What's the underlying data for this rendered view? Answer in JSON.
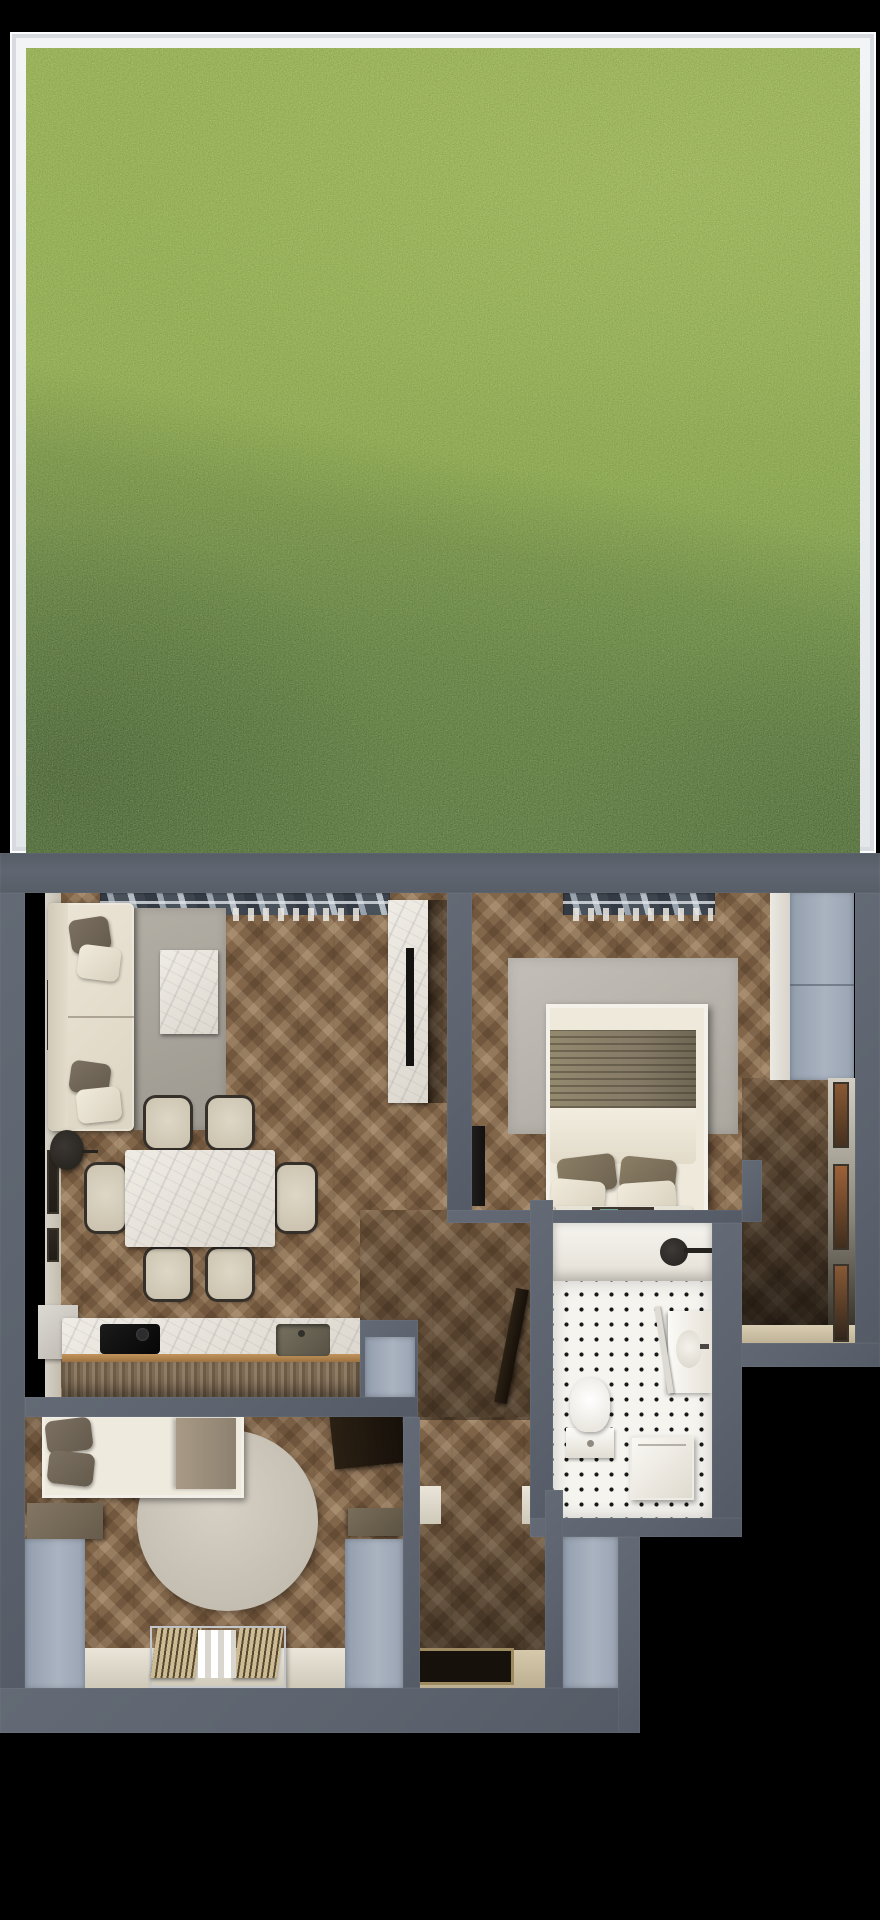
{
  "meta": {
    "title": "Top-down 3D render: apartment floor plan with private terrace lawn",
    "view": "top-down cutaway",
    "background": "#000000"
  },
  "palette": {
    "lawn_light": "#a9bf55",
    "lawn_shadow": "#688c46",
    "frame_white": "#eef0f3",
    "wall_gray": "#5c636e",
    "wardrobe_panel": "#a0aab8",
    "parquet_brown": "#82664a",
    "bathroom_tile": "#f6f4ef",
    "tile_dot": "#181818",
    "upholstery_cream": "#ece5d6",
    "pillow_taupe": "#6e6354",
    "marble_white": "#eae6de"
  },
  "terrace": {
    "name": "Terrace lawn",
    "features": [
      "white frame border",
      "sunlit upper lawn",
      "diagonal shadow across lower lawn"
    ]
  },
  "rooms": {
    "living": {
      "name": "Living room with dining area and kitchen",
      "floor": "herringbone parquet",
      "furniture": [
        "corner sofa with 4 pillows",
        "gray area rug",
        "marble coffee table",
        "marble dining table",
        "6 dining chairs",
        "floor lamp",
        "tall marble cabinet",
        "2 wall artworks",
        "kitchen counter with cooktop and sink",
        "window with blinds"
      ]
    },
    "bedroom1": {
      "name": "Bedroom 1",
      "floor": "herringbone parquet",
      "furniture": [
        "double bed with throw and 4 pillows",
        "area rug",
        "foot bench with tray",
        "wall TV",
        "built-in wardrobe",
        "window with blinds"
      ]
    },
    "bathroom": {
      "name": "Bathroom",
      "floor": "white tile with black dots",
      "furniture": [
        "bathtub with shower head",
        "toilet",
        "vanity with open mirror cabinet",
        "washing machine"
      ]
    },
    "bedroom2": {
      "name": "Bedroom 2",
      "floor": "herringbone parquet",
      "furniture": [
        "single bed with dark pillows",
        "round rug",
        "two wardrobe panels",
        "side cabinet",
        "desk",
        "slatted radiator bench on window sill",
        "open door leaf"
      ]
    },
    "hallway": {
      "name": "Hallway / entry",
      "floor": "herringbone parquet",
      "furniture": [
        "bathroom door leaf",
        "white door jambs",
        "entry door recess",
        "beige threshold"
      ]
    },
    "corridor": {
      "name": "Side corridor",
      "floor": "herringbone parquet",
      "furniture": [
        "3 picture frames",
        "wardrobe panel",
        "beige end sill"
      ]
    }
  }
}
